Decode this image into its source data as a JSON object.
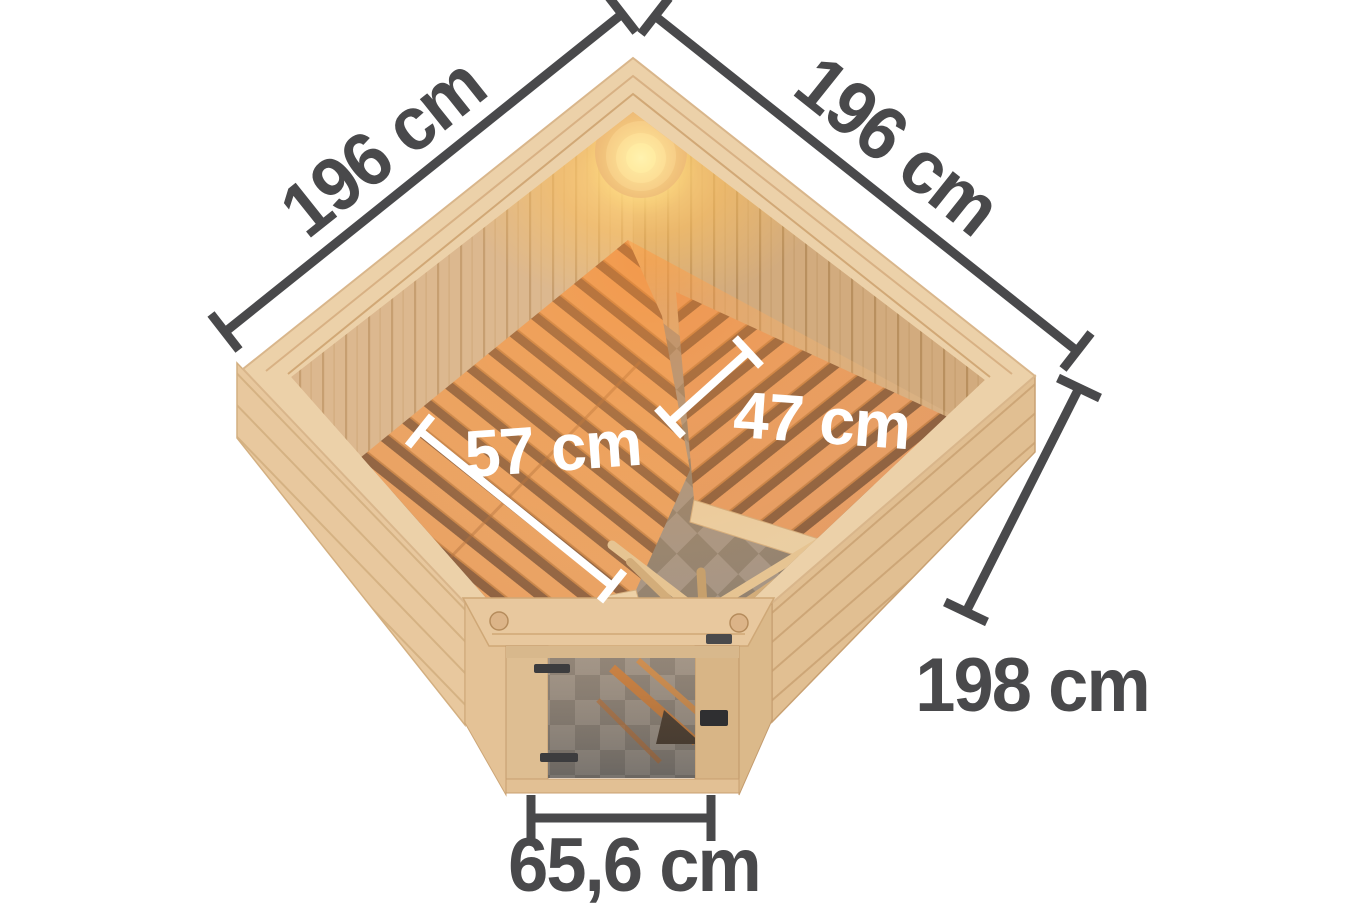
{
  "diagram": {
    "labels": {
      "left_wall": "196 cm",
      "right_wall": "196 cm",
      "bench_left_depth": "57 cm",
      "bench_right_depth": "47 cm",
      "front_right_wall": "198 cm",
      "door_width": "65,6 cm"
    },
    "colors": {
      "background": "#ffffff",
      "dimension_line": "#49494b",
      "dimension_text_dark": "#49494b",
      "dimension_text_light": "#ffffff",
      "wood_rim": "#ecd1a9",
      "wood_exterior": "#e8c89e",
      "wood_wall_interior": "#dcb88f",
      "bench_slat_orange": "#e79b59",
      "bench_gap": "#7d4f30",
      "floor_tile_light": "#9b8c7e",
      "floor_tile_dark": "#857767",
      "lamp_glow": "#ffdf8e",
      "door_hardware": "#3c3c3e"
    }
  }
}
